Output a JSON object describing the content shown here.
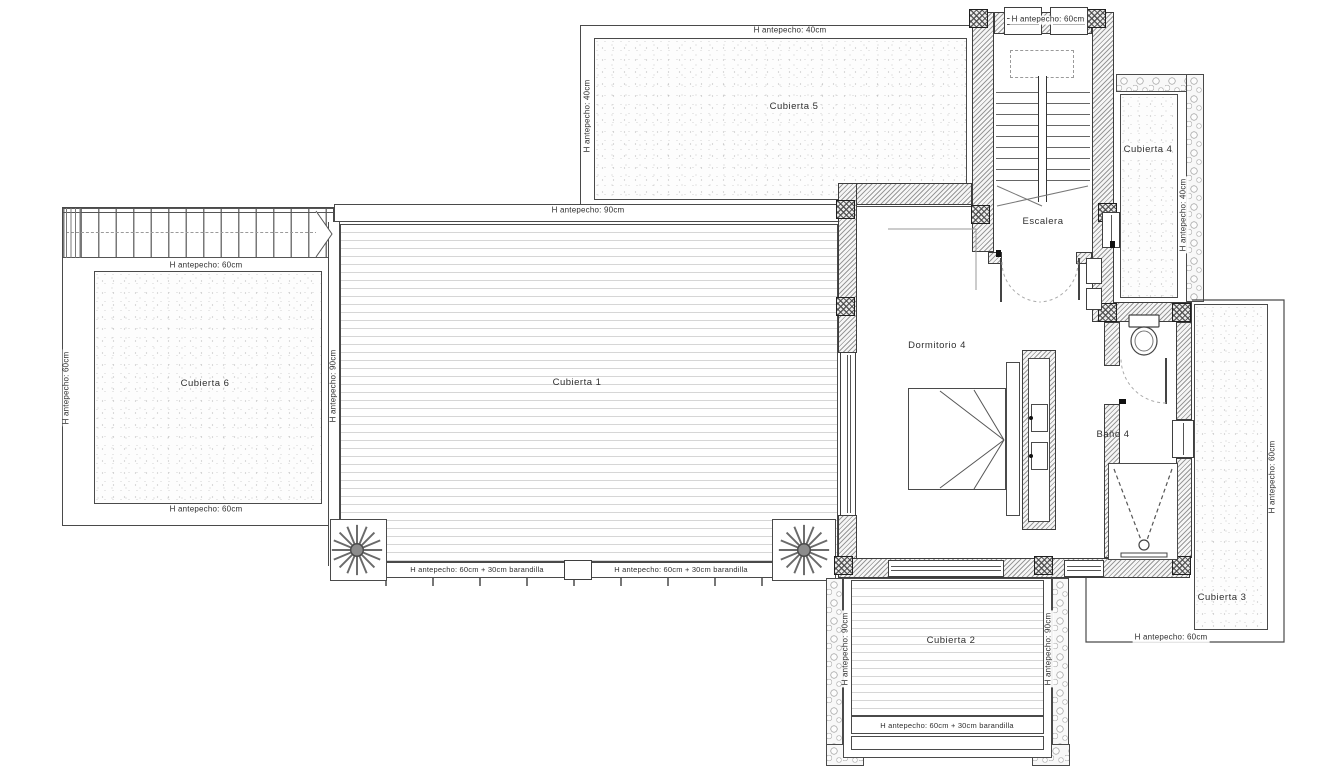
{
  "areas": {
    "cubierta1": "Cubierta 1",
    "cubierta2": "Cubierta 2",
    "cubierta3": "Cubierta 3",
    "cubierta4": "Cubierta 4",
    "cubierta5": "Cubierta 5",
    "cubierta6": "Cubierta 6",
    "dormitorio4": "Dormitorio 4",
    "bano4": "Baño 4",
    "escalera": "Escalera"
  },
  "parapets": {
    "stair_top": "H antepecho: 60cm",
    "c5_top": "H antepecho: 40cm",
    "c5_left": "H antepecho: 40cm",
    "c4_right": "H antepecho: 40cm",
    "c1_top": "H antepecho: 90cm",
    "c1_left": "H antepecho: 90cm",
    "c1_bottom_left": "H antepecho: 60cm + 30cm barandilla",
    "c1_bottom_right": "H antepecho: 60cm + 30cm barandilla",
    "c6_top": "H antepecho: 60cm",
    "c6_left": "H antepecho: 60cm",
    "c6_bottom": "H antepecho: 60cm",
    "c2_left": "H antepecho: 90cm",
    "c2_right": "H antepecho: 90cm",
    "c2_bottom": "H antepecho: 60cm + 30cm barandilla",
    "c3_right": "H antepecho: 60cm",
    "c3_bottom": "H antepecho: 60cm"
  },
  "colors": {
    "line": "#4a4a4a",
    "wall_hatch": "#999999",
    "deck_line": "#d6d6d6",
    "stipple_dot": "#bfbfbf",
    "stone": "#8f8f8f",
    "text": "#2f2f2f",
    "paper": "#ffffff"
  }
}
